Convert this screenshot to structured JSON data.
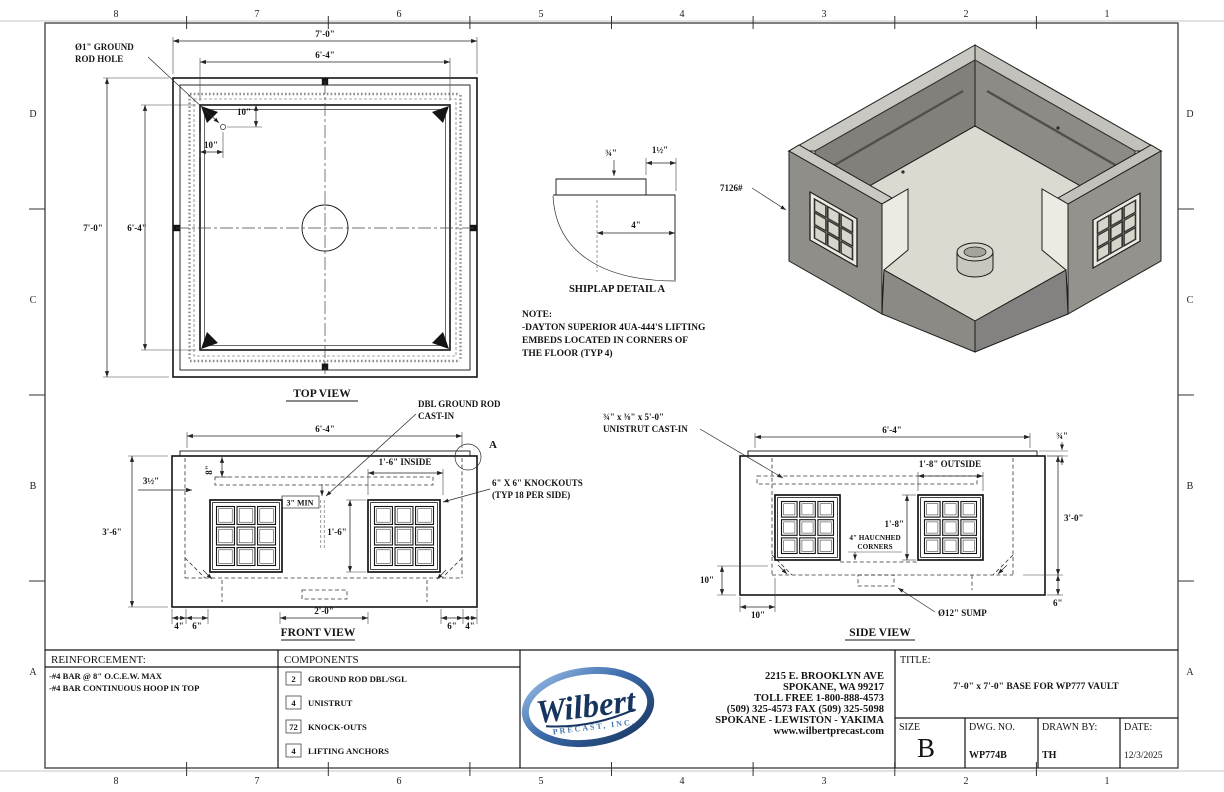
{
  "sheet": {
    "zone_numbers": [
      "8",
      "7",
      "6",
      "5",
      "4",
      "3",
      "2",
      "1"
    ],
    "zone_letters": [
      "D",
      "C",
      "B",
      "A"
    ]
  },
  "top_view": {
    "title": "TOP VIEW",
    "dim_outer_w": "7'-0\"",
    "dim_inner_w": "6'-4\"",
    "dim_outer_h": "7'-0\"",
    "dim_inner_h": "6'-4\"",
    "ground_rod_l1": "Ø1\" GROUND",
    "ground_rod_l2": "ROD HOLE",
    "dim_hole_v": "10\"",
    "dim_hole_h": "10\""
  },
  "shiplap": {
    "title": "SHIPLAP DETAIL A",
    "dim_lip": "¾\"",
    "dim_offset": "1½\"",
    "dim_depth": "4\""
  },
  "note": {
    "l1": "NOTE:",
    "l2": "-DAYTON SUPERIOR 4UA-444'S LIFTING",
    "l3": "EMBEDS LOCATED IN CORNERS OF",
    "l4": "THE FLOOR (TYP 4)"
  },
  "iso": {
    "weight": "7126#"
  },
  "front_view": {
    "title": "FRONT VIEW",
    "dim_top": "6'-4\"",
    "dbl_rod_l1": "DBL GROUND ROD",
    "dbl_rod_l2": "CAST-IN",
    "detail_a": "A",
    "dim_8": "8\"",
    "dim_wall": "3½\"",
    "dim_h": "3'-6\"",
    "dim_inside": "1'-6\" INSIDE",
    "ko_l1": "6\" X 6\" KNOCKOUTS",
    "ko_l2": "(TYP 18 PER SIDE)",
    "dim_3min": "3\" MIN",
    "dim_ko_h": "1'-6\"",
    "dim_b_4l": "4\"",
    "dim_b_6l": "6\"",
    "dim_b_20": "2'-0\"",
    "dim_b_6r": "6\"",
    "dim_b_4r": "4\""
  },
  "side_view": {
    "title": "SIDE VIEW",
    "unistrut_l1": "¾\" x ⅜\" x 5'-0\"",
    "unistrut_l2": "UNISTRUT CAST-IN",
    "dim_top": "6'-4\"",
    "dim_lip": "¾\"",
    "dim_outside": "1'-8\" OUTSIDE",
    "dim_ko_h": "1'-8\"",
    "dim_h": "3'-0\"",
    "haunch_l1": "4\" HAUCNHED",
    "haunch_l2": "CORNERS",
    "dim_10v": "10\"",
    "dim_10h": "10\"",
    "sump": "Ø12\" SUMP",
    "dim_6": "6\""
  },
  "title_block": {
    "reinforcement_header": "REINFORCEMENT:",
    "reinforcement_1": "-#4 BAR @ 8\" O.C.E.W. MAX",
    "reinforcement_2": "-#4 BAR CONTINUOUS HOOP IN TOP",
    "components_header": "COMPONENTS",
    "components": [
      {
        "qty": "2",
        "name": "GROUND ROD DBL/SGL"
      },
      {
        "qty": "4",
        "name": "UNISTRUT"
      },
      {
        "qty": "72",
        "name": "KNOCK-OUTS"
      },
      {
        "qty": "4",
        "name": "LIFTING ANCHORS"
      }
    ],
    "logo_script": "Wilbert",
    "logo_sub": "PRECAST, INC.",
    "addr1": "2215 E. BROOKLYN AVE",
    "addr2": "SPOKANE, WA 99217",
    "addr3": "TOLL FREE 1-800-888-4573",
    "addr4": "(509) 325-4573      FAX (509) 325-5098",
    "addr5": "SPOKANE - LEWISTON - YAKIMA",
    "addr6": "www.wilbertprecast.com",
    "title_label": "TITLE:",
    "title_value": "7'-0\" x 7'-0\" BASE FOR WP777 VAULT",
    "size_label": "SIZE",
    "size_value": "B",
    "dwg_label": "DWG.  NO.",
    "dwg_value": "WP774B",
    "drawn_label": "DRAWN BY:",
    "drawn_value": "TH",
    "date_label": "DATE:",
    "date_value": "12/3/2025"
  }
}
